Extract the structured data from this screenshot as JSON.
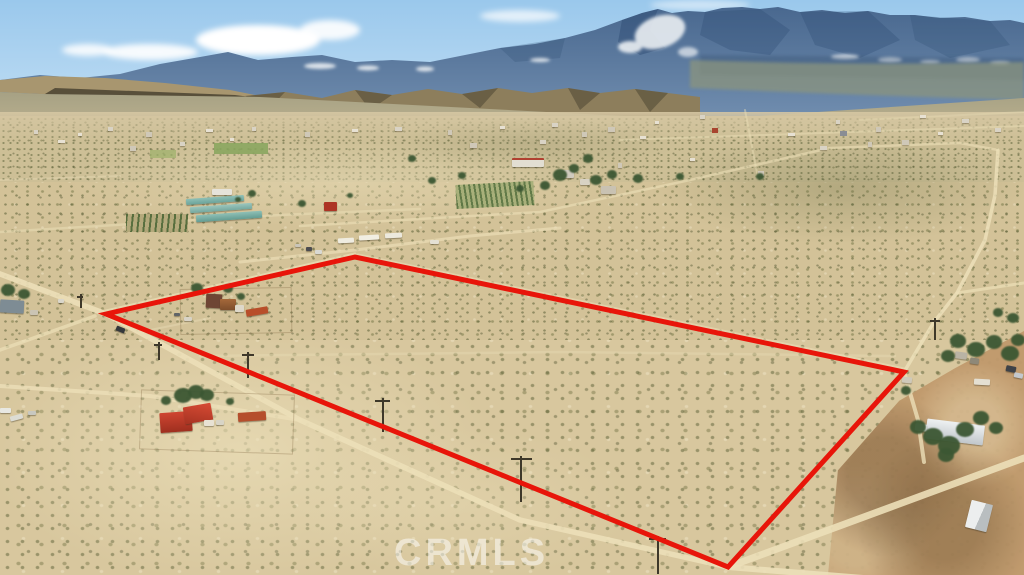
{
  "photo": {
    "kind": "aerial drone photograph",
    "subject": "vacant desert land parcel outlined in red for a real-estate listing, mountain range in background",
    "watermark_text": "CRMLS"
  },
  "boundary": {
    "color": "#e8150a",
    "stroke_width": 5,
    "vertices": [
      [
        106,
        314
      ],
      [
        355,
        257
      ],
      [
        904,
        372
      ],
      [
        728,
        567
      ]
    ]
  },
  "palette": {
    "sky": "#9ac8ec",
    "cloud": "#ffffff",
    "mountains": "#49688f",
    "mountain_snow": "#e6ebf0",
    "foothills": "#a8966f",
    "desert_sand": "#d5c49b",
    "scrub_green": "#6d7243",
    "road": "#ecdfb8",
    "red_roof_house": "#c13c2a",
    "shipping_container": "#b54e2c",
    "dirt_pad": "#c09a6d"
  }
}
